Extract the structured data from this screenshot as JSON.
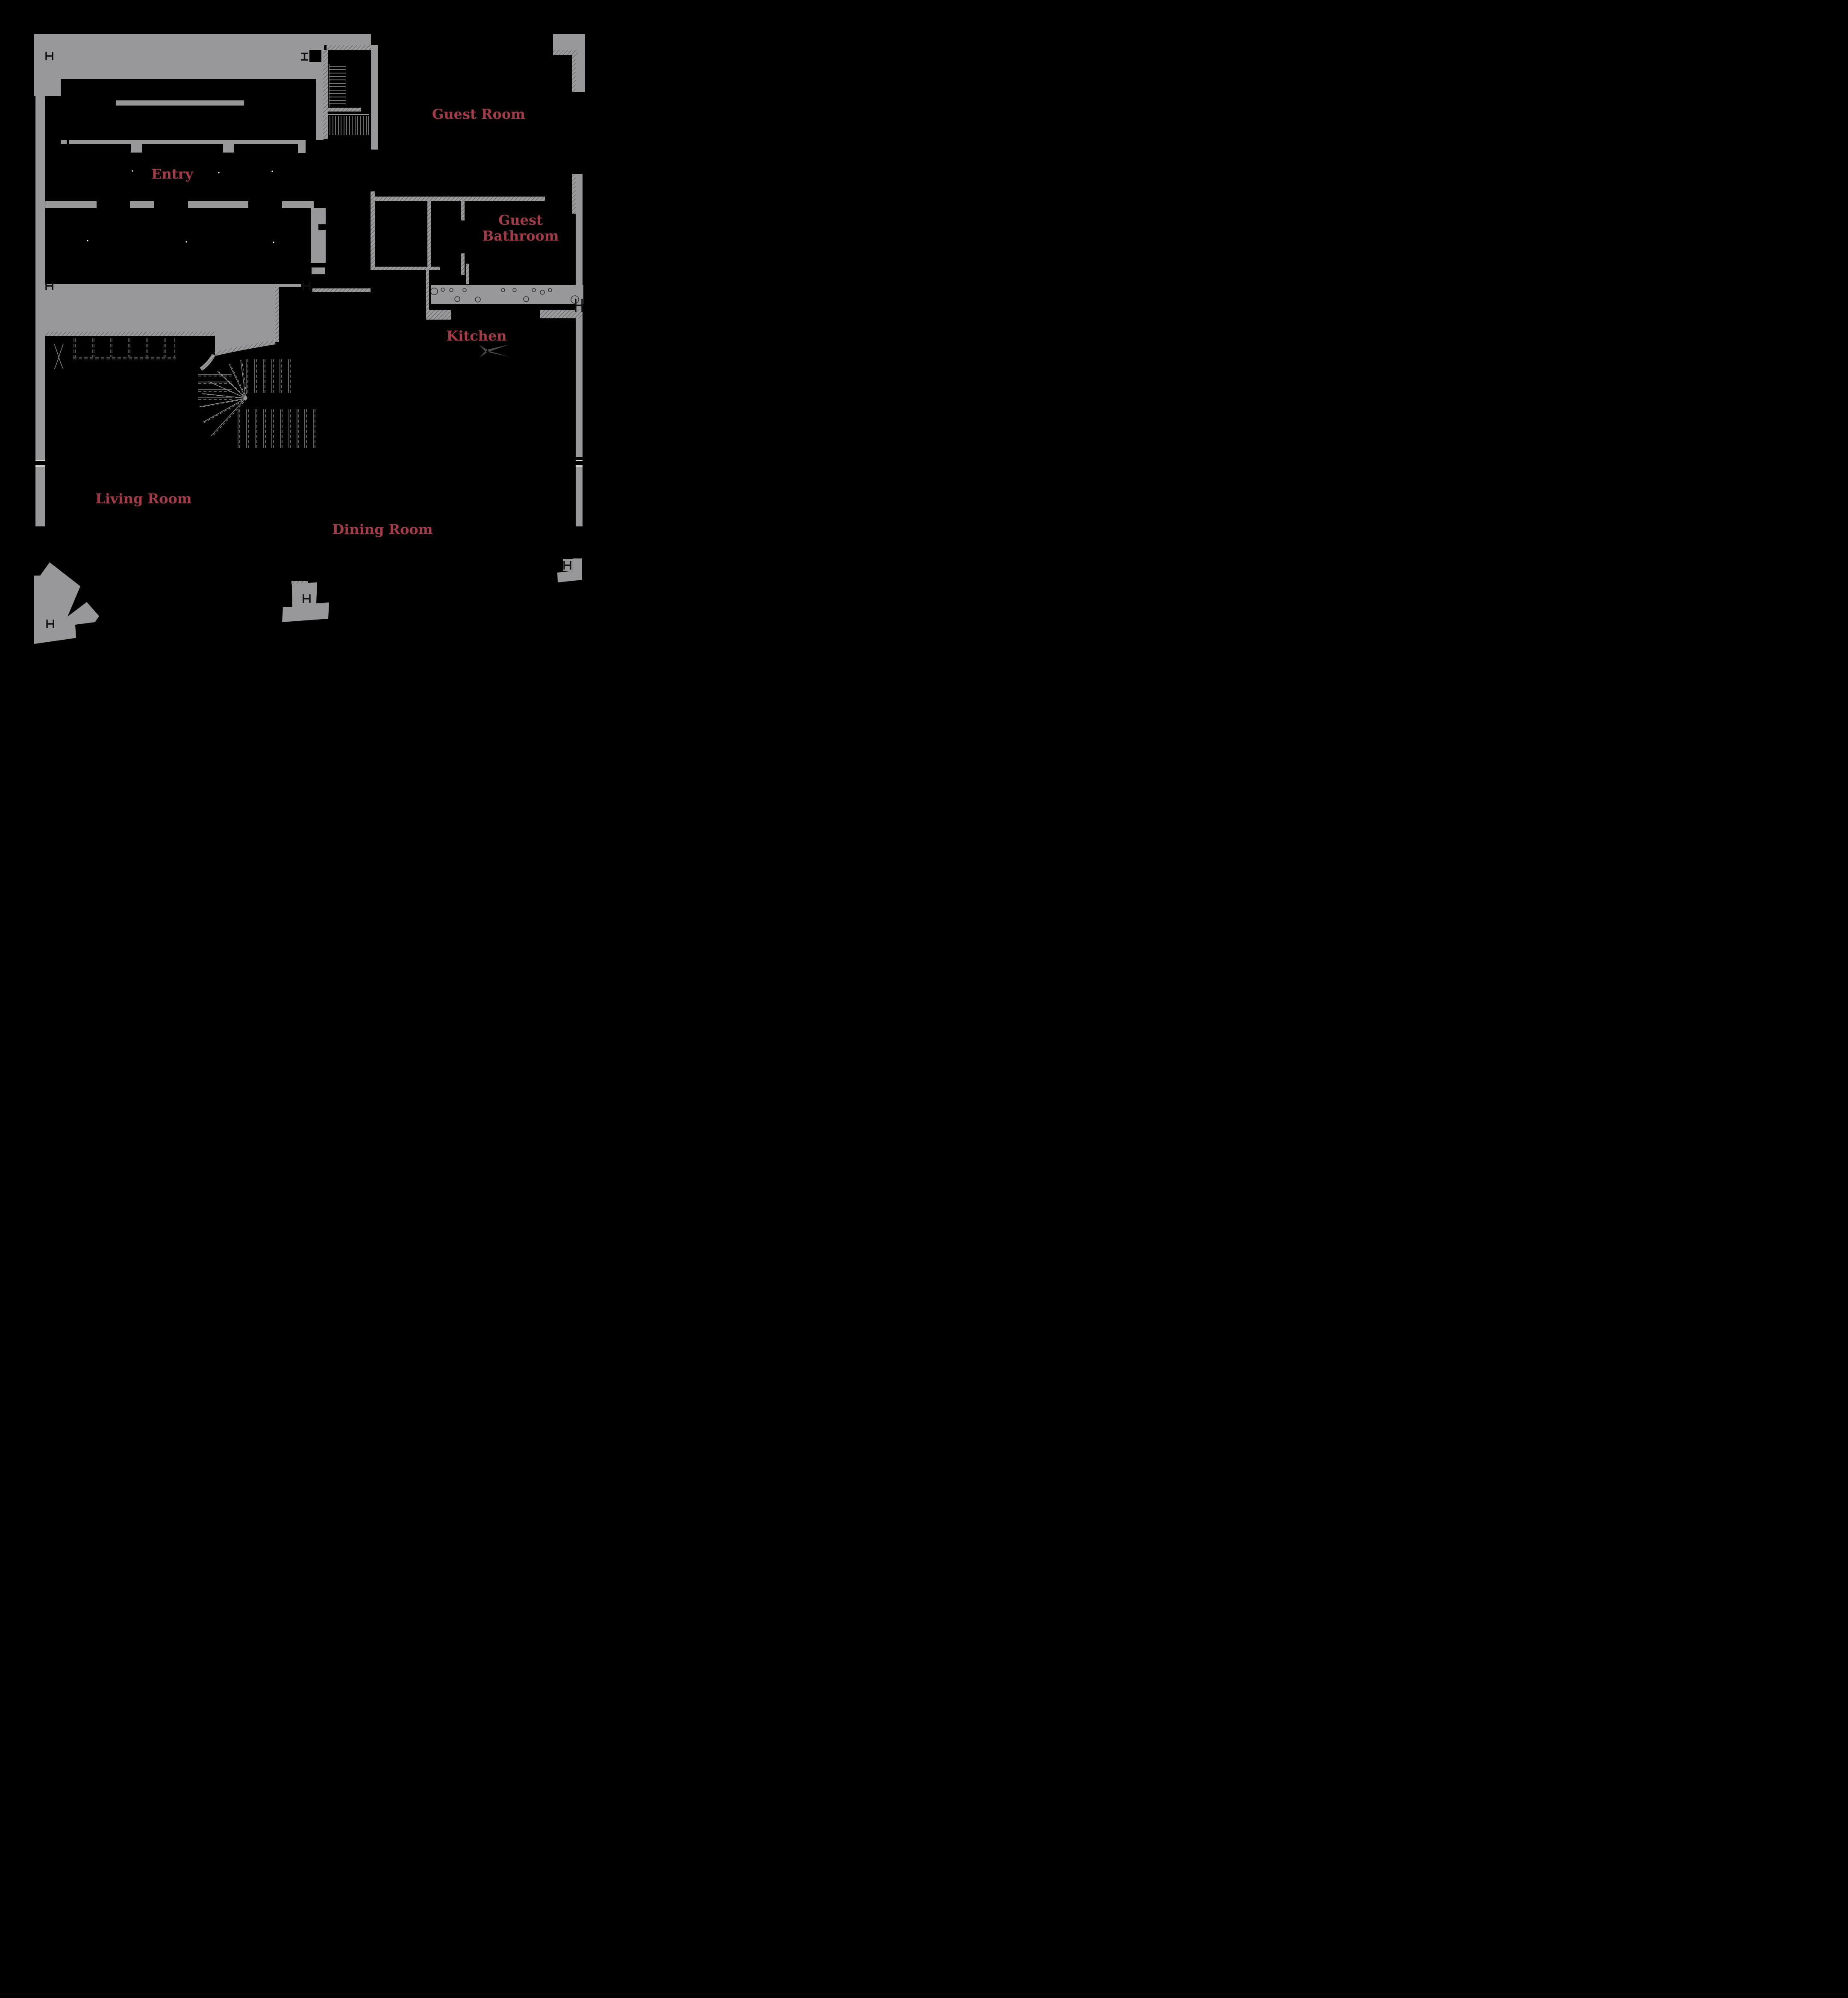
{
  "document": {
    "type": "architectural-floor-plan",
    "floor": "first-floor"
  },
  "palette": {
    "background": "#000000",
    "wall_gray": "#98989b",
    "hatch_gray": "#9b9b9e",
    "hatch_line": "#2a2a2a",
    "label_red": "#a43b47",
    "stair_line_gray": "#9a9a9c",
    "marker_black": "#101010",
    "fixture_gray": "#4a4a4a",
    "pebble_outline": "#1d1d1d"
  },
  "rooms": [
    {
      "id": "entry",
      "label": "Entry"
    },
    {
      "id": "guest-room",
      "label": "Guest Room"
    },
    {
      "id": "guest-bathroom",
      "label_line1": "Guest",
      "label_line2": "Bathroom"
    },
    {
      "id": "kitchen",
      "label": "Kitchen"
    },
    {
      "id": "living-room",
      "label": "Living Room"
    },
    {
      "id": "dining-room",
      "label": "Dining Room"
    }
  ],
  "symbols": {
    "steel_column_markers": 8,
    "icons": [
      "steel-column-h-marker-icon",
      "steel-column-ibeam-marker-icon",
      "light-fixture-star-icon",
      "winder-stair-treads",
      "pebble-strip",
      "dashed-closet-doors"
    ]
  }
}
